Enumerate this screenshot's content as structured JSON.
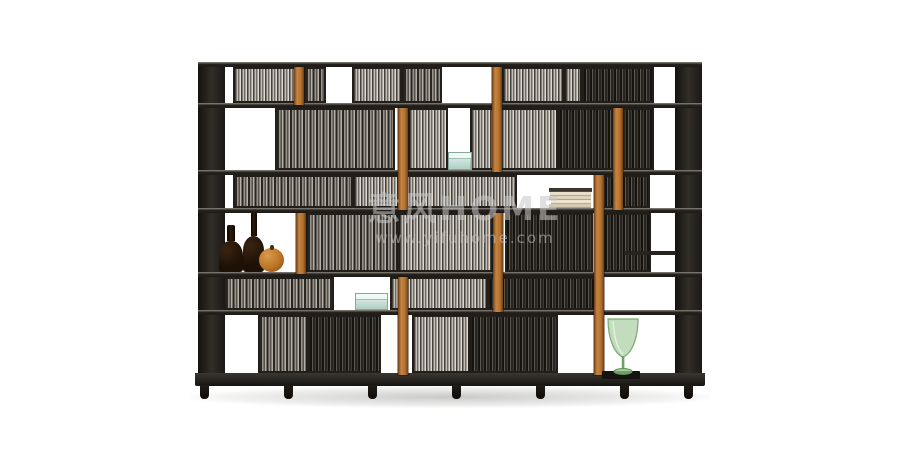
{
  "scene": {
    "type": "furniture-product-photo",
    "description": "Tall black open shelving unit / room divider with fine vertical slat panels, orange leather strap accents and decorative objects, on a plain white studio background",
    "background": "#ffffff"
  },
  "watermark": {
    "line1": "意风HOME",
    "line2": "www.yifuhome.com"
  },
  "palette": {
    "background": "#ffffff",
    "frame": "#221f1a",
    "shelf-top": "#8d8880",
    "strap": "#b5712f",
    "strap-hi": "#c58441",
    "strap-lo": "#6e3f14",
    "bottle": "#1d1006",
    "gourd": "#bc7426",
    "teal": "#bcd6cd",
    "book-page": "#e7dfca",
    "goblet": "#8fbf86",
    "mat": "#16130f",
    "watermark": "#c8c8c8"
  },
  "furniture": {
    "label": "black slatted shelving unit with leather straps",
    "geometry": {
      "x": 198,
      "y": 62,
      "width": 504,
      "height": 340,
      "shelves": [
        0,
        41,
        108,
        146,
        210,
        248,
        311
      ],
      "sides": [
        {
          "x": 0,
          "w": 27
        },
        {
          "x": 477,
          "w": 27
        }
      ],
      "rows": [
        {
          "y": 5,
          "h": 36,
          "cells": [
            {
              "x": 35,
              "w": 63,
              "t": "light"
            },
            {
              "x": 106,
              "w": 22,
              "t": "mid"
            },
            {
              "x": 154,
              "w": 50,
              "t": "light"
            },
            {
              "x": 204,
              "w": 40,
              "t": "mid"
            },
            {
              "x": 304,
              "w": 62,
              "t": "light"
            },
            {
              "x": 366,
              "w": 18,
              "t": "light"
            },
            {
              "x": 384,
              "w": 72,
              "t": "dark"
            }
          ]
        },
        {
          "y": 46,
          "h": 62,
          "cells": [
            {
              "x": 77,
              "w": 120,
              "t": "mid"
            },
            {
              "x": 210,
              "w": 40,
              "t": "light"
            },
            {
              "x": 272,
              "w": 88,
              "t": "light"
            },
            {
              "x": 360,
              "w": 96,
              "t": "dark"
            }
          ]
        },
        {
          "y": 113,
          "h": 33,
          "cells": [
            {
              "x": 35,
              "w": 120,
              "t": "mid"
            },
            {
              "x": 155,
              "w": 164,
              "t": "light"
            },
            {
              "x": 399,
              "w": 53,
              "t": "dark"
            }
          ]
        },
        {
          "y": 151,
          "h": 59,
          "cells": [
            {
              "x": 108,
              "w": 92,
              "t": "mid"
            },
            {
              "x": 200,
              "w": 95,
              "t": "light"
            },
            {
              "x": 307,
              "w": 88,
              "t": "dark"
            },
            {
              "x": 405,
              "w": 48,
              "t": "dark"
            }
          ]
        },
        {
          "y": 215,
          "h": 33,
          "cells": [
            {
              "x": 26,
              "w": 110,
              "t": "mid"
            },
            {
              "x": 192,
              "w": 98,
              "t": "light"
            },
            {
              "x": 290,
              "w": 110,
              "t": "dark"
            }
          ]
        },
        {
          "y": 253,
          "h": 58,
          "cells": [
            {
              "x": 60,
              "w": 50,
              "t": "mid"
            },
            {
              "x": 110,
              "w": 73,
              "t": "dark"
            },
            {
              "x": 214,
              "w": 58,
              "t": "light"
            },
            {
              "x": 272,
              "w": 88,
              "t": "dark"
            }
          ]
        }
      ],
      "straps": [
        {
          "x": 96,
          "y": 5,
          "h": 38
        },
        {
          "x": 294,
          "y": 5,
          "h": 105
        },
        {
          "x": 200,
          "y": 46,
          "h": 102
        },
        {
          "x": 415,
          "y": 46,
          "h": 102
        },
        {
          "x": 396,
          "y": 113,
          "h": 200
        },
        {
          "x": 98,
          "y": 151,
          "h": 61
        },
        {
          "x": 295,
          "y": 151,
          "h": 99
        },
        {
          "x": 200,
          "y": 215,
          "h": 98
        }
      ],
      "mini_shelves": [
        {
          "x": 426,
          "y": 189,
          "w": 52
        }
      ],
      "feet": [
        2,
        86,
        170,
        254,
        338,
        422,
        486
      ]
    }
  },
  "decor": {
    "items": [
      "tall dark amber bottle",
      "short dark amber bottle",
      "orange gourd sphere",
      "small teal glass box (upper shelf)",
      "stack of books with cream pages",
      "teal glass box with lid (lower shelf)",
      "green glass goblet vase on dark mat"
    ]
  }
}
